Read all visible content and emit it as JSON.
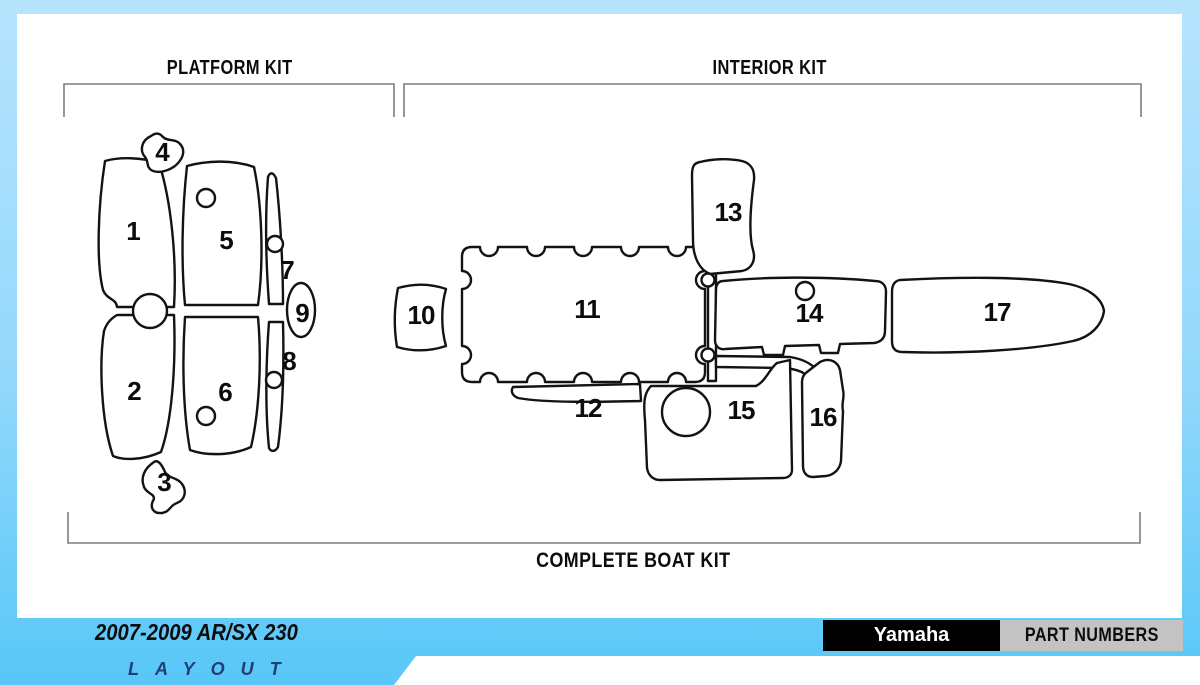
{
  "titles": {
    "platform_kit": "PLATFORM KIT",
    "interior_kit": "INTERIOR KIT",
    "complete_boat_kit": "COMPLETE BOAT KIT"
  },
  "diagram": {
    "part_labels": [
      "1",
      "2",
      "3",
      "4",
      "5",
      "6",
      "7",
      "8",
      "9",
      "10",
      "11",
      "12",
      "13",
      "14",
      "15",
      "16",
      "17"
    ]
  },
  "footer": {
    "model": "2007-2009 AR/SX 230",
    "layout_word": "LAYOUT",
    "brand": "Yamaha",
    "part_numbers_label": "PART NUMBERS"
  },
  "colors": {
    "background_top": "#b6e4fd",
    "background_bottom": "#57c7f8",
    "part_outline": "#131313",
    "bracket_line": "#7d7d7d",
    "brand_block_bg": "#000000",
    "brand_block_text": "#ffffff",
    "part_numbers_bg": "#c3c3c3",
    "layout_text_color": "#1d4077"
  }
}
